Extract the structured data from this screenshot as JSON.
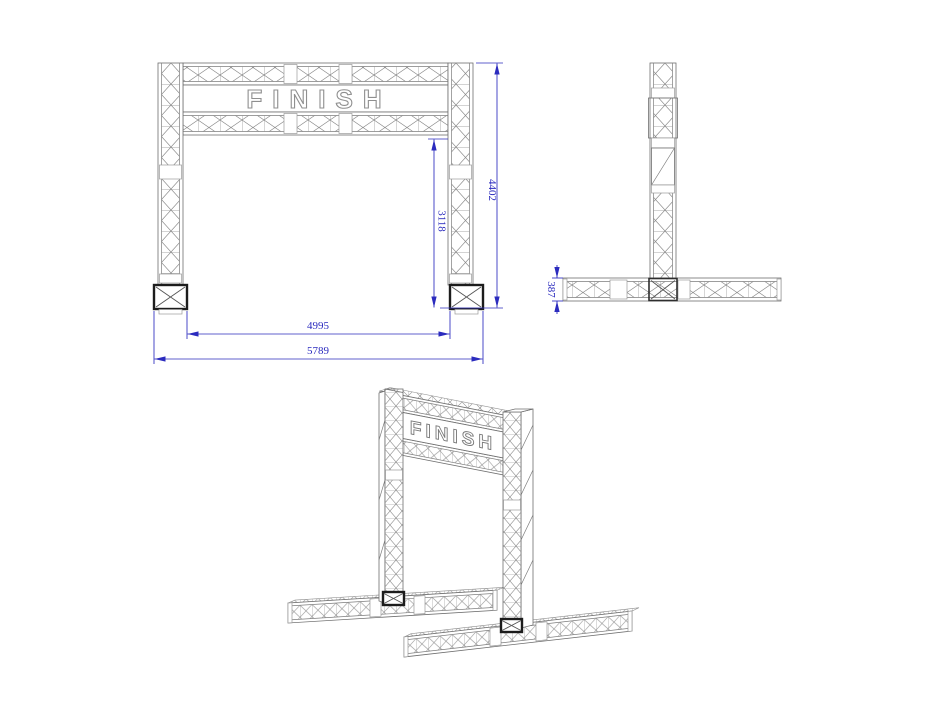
{
  "banner": {
    "text": "FINISH"
  },
  "views": {
    "front": {
      "dims": {
        "overall_height": "4402",
        "clear_height": "3118",
        "inner_span": "4995",
        "overall_width": "5789"
      }
    },
    "side": {
      "dims": {
        "base_truss_height": "387"
      }
    },
    "iso": {
      "banner_text": "FINISH"
    }
  },
  "colors": {
    "background": "#ffffff",
    "geometry_line": "#6f6f6f",
    "dimension": "#2b2bbe",
    "base_block": "#1c1c1c"
  }
}
